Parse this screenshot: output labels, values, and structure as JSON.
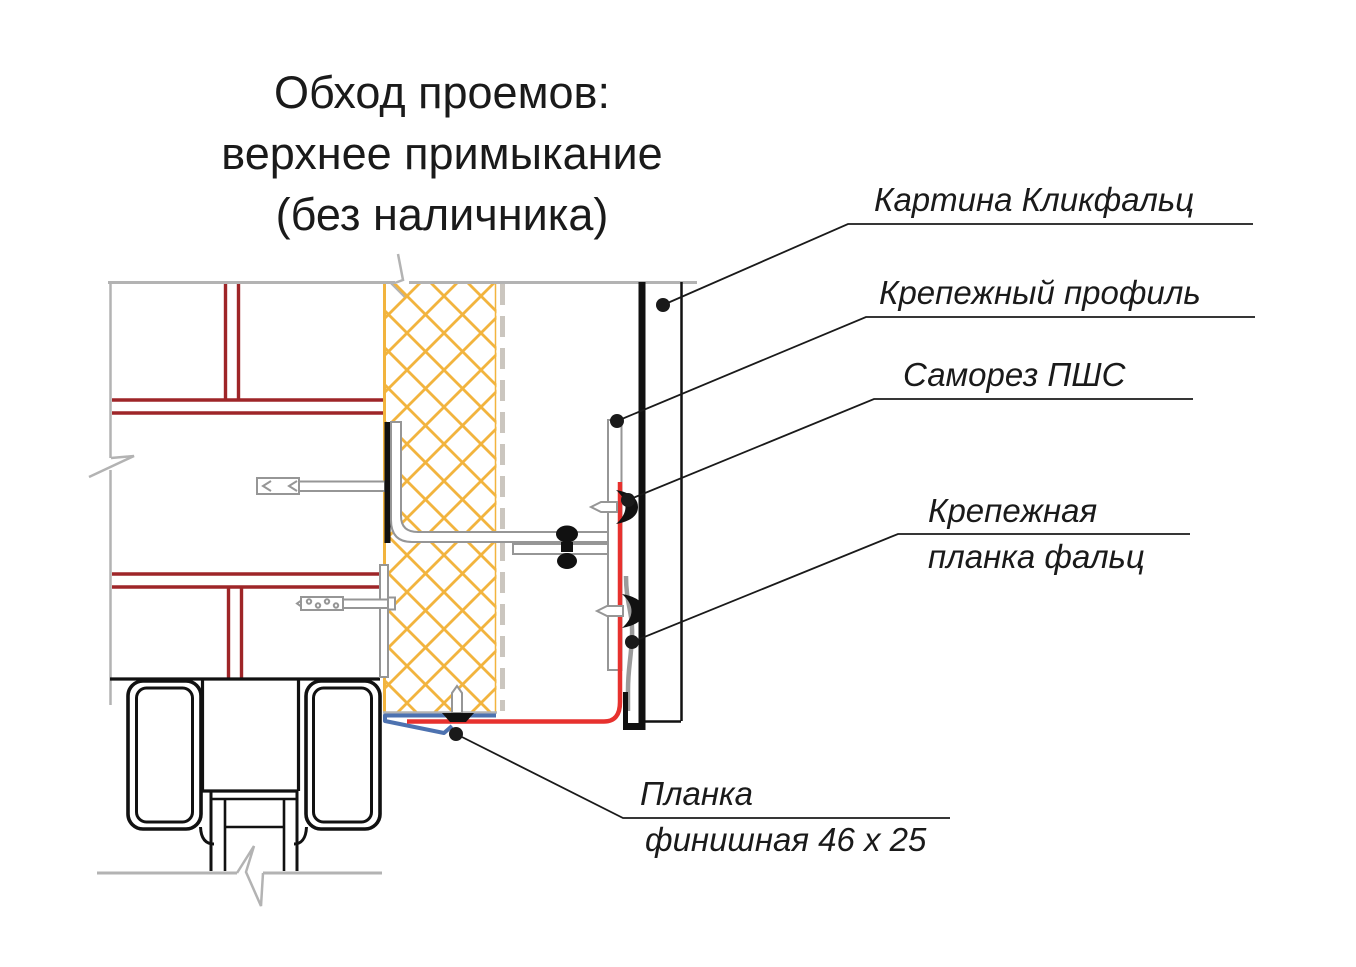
{
  "title": {
    "line1": "Обход проемов:",
    "line2": "верхнее примыкание",
    "line3": "(без наличника)"
  },
  "labels": {
    "klickfalz": "Картина Кликфальц",
    "mount_profile": "Крепежный профиль",
    "screw_pshs": "Саморез ПШС",
    "falz_strip_line1": "Крепежная",
    "falz_strip_line2": "планка фальц",
    "finish_strip_line1": "Планка",
    "finish_strip_line2": "финишная 46 x 25"
  },
  "colors": {
    "brick_joint": "#9e2528",
    "flashing_red": "#e7312e",
    "flashing_blue": "#4d72b0",
    "insulation_yellow": "#f2b43e",
    "wall_outline_gray": "#b3b3b3",
    "metal_gray": "#969696",
    "membrane_gray": "#cbc6bf",
    "strip_gray": "#9b9b9b",
    "line_black": "#111111",
    "text_black": "#1a1a1a"
  }
}
